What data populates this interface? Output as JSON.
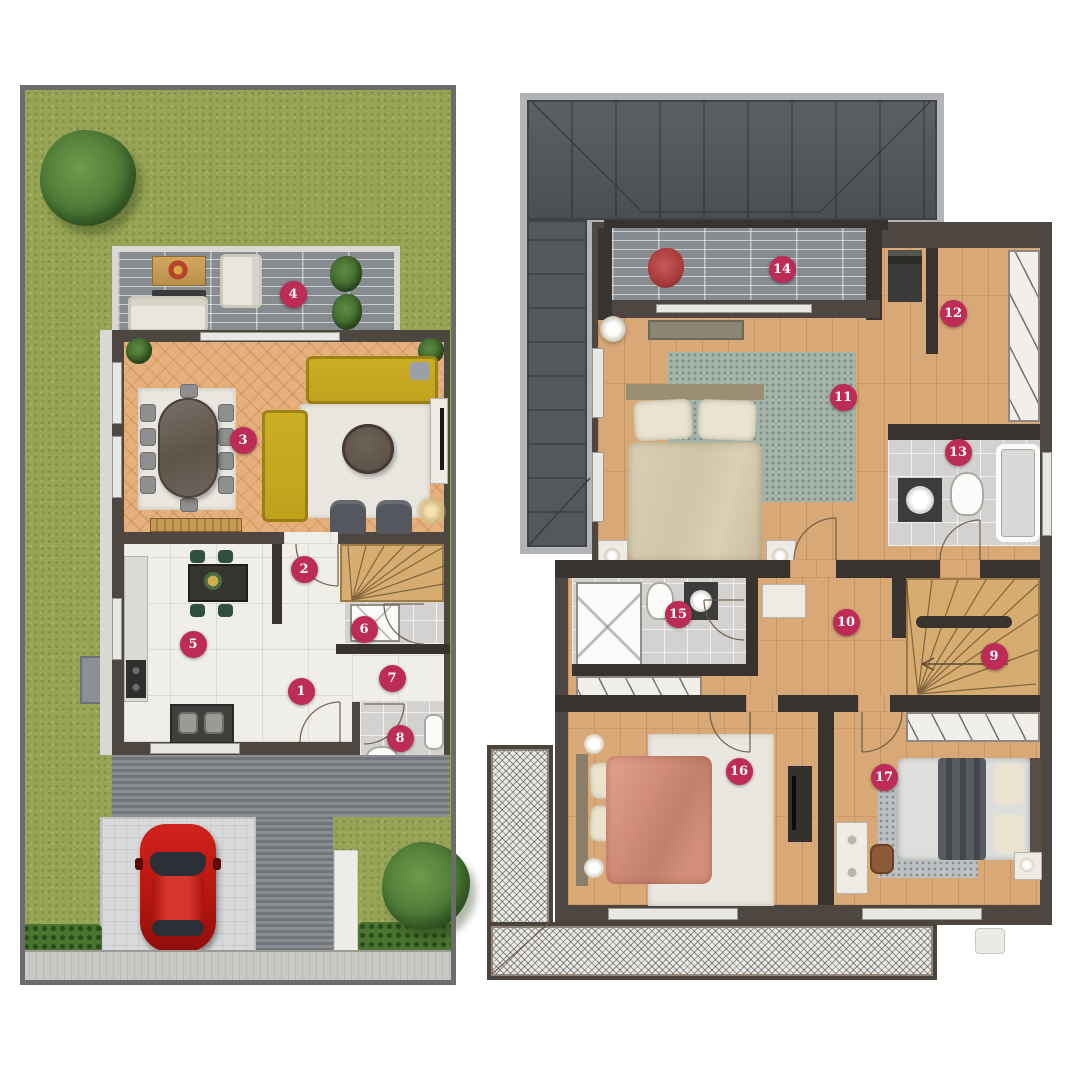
{
  "palette": {
    "marker": "#bd2b57",
    "marker_text": "#ffffff",
    "grass": "#98a455",
    "tree": "#4d7a37",
    "tree_dark": "#3c632c",
    "frame": "#6c6c6c",
    "deck": "#878c91",
    "concrete": "#d9d8d2",
    "wall": "#4e4741",
    "wall_dark": "#38332e",
    "parquet": "#e6b07c",
    "wood_floor": "#d9a877",
    "white_floor": "#f0eee9",
    "tile": "#d3d2d0",
    "stair_wood": "#d6ac70",
    "roof": "#54575b",
    "roof_border": "#b2b3b5",
    "sofa": "#ccae24",
    "chair_gray": "#8f8f8f",
    "armchair": "#54575d",
    "rug_white": "#eae7e0",
    "rug_teal": "#a5b4aa",
    "rug_gray": "#bdc0c2",
    "table_dark": "#5e5449",
    "car": "#c11b17",
    "glass": "#2b3036",
    "drive": "#7e8185",
    "pad": "#d7d9da",
    "walk": "#edece8",
    "hedge": "#4a7430",
    "sidewalk": "#cac9c5",
    "bed_beige": "#d9d0b5",
    "pillow": "#e9e3cf",
    "bed_pink": "#d28d7b",
    "bed_pink_light": "#dfa38f",
    "bed_white": "#dedfdd",
    "throw_gray": "#575b60",
    "closet": "#f1efe9",
    "counter": "#dadad6",
    "island": "#35342f",
    "green_chair": "#2f4f40",
    "plant_red": "#a83a3c",
    "lamp": "#d9c08a",
    "white_furn": "#edebe4",
    "balcony_bg": "#e9e9e7"
  },
  "markers": [
    {
      "n": "1",
      "x": 301,
      "y": 691
    },
    {
      "n": "2",
      "x": 304,
      "y": 569
    },
    {
      "n": "3",
      "x": 243,
      "y": 440
    },
    {
      "n": "4",
      "x": 293,
      "y": 294
    },
    {
      "n": "5",
      "x": 193,
      "y": 644
    },
    {
      "n": "6",
      "x": 364,
      "y": 629
    },
    {
      "n": "7",
      "x": 392,
      "y": 678
    },
    {
      "n": "8",
      "x": 400,
      "y": 738
    },
    {
      "n": "9",
      "x": 994,
      "y": 656
    },
    {
      "n": "10",
      "x": 846,
      "y": 622
    },
    {
      "n": "11",
      "x": 843,
      "y": 397
    },
    {
      "n": "12",
      "x": 953,
      "y": 313
    },
    {
      "n": "13",
      "x": 958,
      "y": 452
    },
    {
      "n": "14",
      "x": 782,
      "y": 269
    },
    {
      "n": "15",
      "x": 678,
      "y": 614
    },
    {
      "n": "16",
      "x": 739,
      "y": 771
    },
    {
      "n": "17",
      "x": 884,
      "y": 777
    }
  ]
}
